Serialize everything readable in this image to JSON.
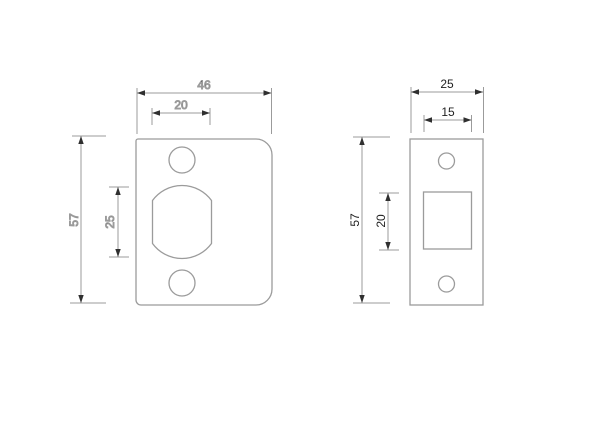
{
  "page": {
    "background": "#ffffff"
  },
  "drawing": {
    "type": "technical-dimension-drawing",
    "subject": "door latch faceplates, front views",
    "line_color": "#9b9b9b",
    "arrow_color": "#2f2f2f",
    "text_color": "#1f1f1f",
    "left_view": {
      "name": "radius-corner-faceplate",
      "dims": {
        "overall_width": "46",
        "cutout_flat_width": "20",
        "overall_height": "57",
        "cutout_height": "25"
      }
    },
    "right_view": {
      "name": "square-corner-faceplate",
      "dims": {
        "overall_width": "25",
        "hole_width": "15",
        "overall_height": "57",
        "hole_height": "20"
      }
    }
  }
}
